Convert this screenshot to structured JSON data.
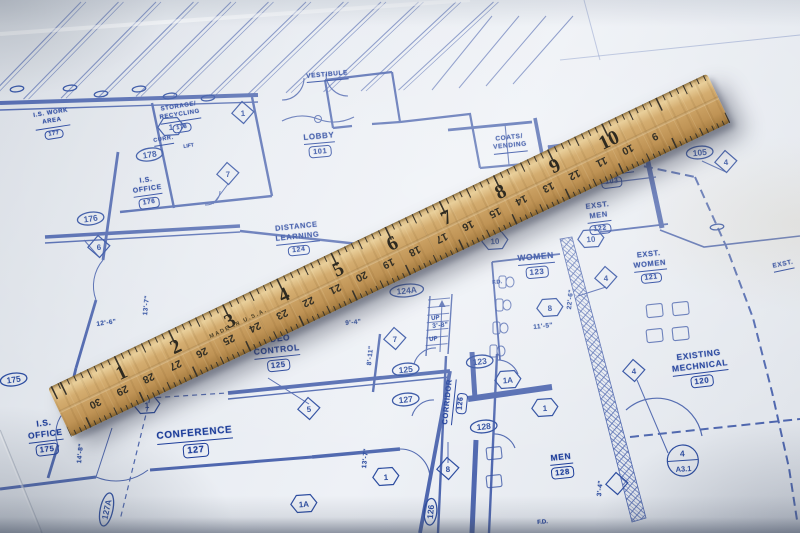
{
  "colors": {
    "ink": "#3a55a5",
    "ink_bold": "#1d3d9a",
    "paper": "#e7ebf1",
    "wood": "#c99f61",
    "tick": "#39342b"
  },
  "blueprint": {
    "rooms": [
      {
        "id": "is-work-area",
        "lines": [
          "I.S. WORK",
          "AREA"
        ],
        "number": "177"
      },
      {
        "id": "storage-recycling",
        "lines": [
          "STORAGE/",
          "RECYCLING"
        ],
        "number": "178"
      },
      {
        "id": "curr",
        "lines": [
          "CURR."
        ],
        "number": ""
      },
      {
        "id": "is-office-176",
        "lines": [
          "I.S.",
          "OFFICE"
        ],
        "number": "176"
      },
      {
        "id": "vestibule",
        "lines": [
          "VESTIBULE"
        ],
        "number": ""
      },
      {
        "id": "lobby",
        "lines": [
          "LOBBY"
        ],
        "number": "101"
      },
      {
        "id": "coats-vending",
        "lines": [
          "COATS/",
          "VENDING"
        ],
        "number": ""
      },
      {
        "id": "corridor-103",
        "lines": [
          "CORRIDOR"
        ],
        "number": "103"
      },
      {
        "id": "exst-men",
        "lines": [
          "EXST.",
          "MEN"
        ],
        "number": "122"
      },
      {
        "id": "women",
        "lines": [
          "WOMEN"
        ],
        "number": "123"
      },
      {
        "id": "exst-women",
        "lines": [
          "EXST.",
          "WOMEN"
        ],
        "number": "121"
      },
      {
        "id": "existing-mechanical",
        "lines": [
          "EXISTING",
          "MECHNICAL"
        ],
        "number": "120"
      },
      {
        "id": "distance-learning",
        "lines": [
          "DISTANCE",
          "LEARNING"
        ],
        "number": "124"
      },
      {
        "id": "video-control",
        "lines": [
          "VIDEO",
          "CONTROL"
        ],
        "number": "125"
      },
      {
        "id": "conference",
        "lines": [
          "CONFERENCE"
        ],
        "number": "127"
      },
      {
        "id": "corridor-126",
        "lines": [
          "CORRIDOR"
        ],
        "number": "126"
      },
      {
        "id": "men-128",
        "lines": [
          "MEN"
        ],
        "number": "128"
      },
      {
        "id": "is-office-175",
        "lines": [
          "I.S.",
          "OFFICE"
        ],
        "number": "175"
      },
      {
        "id": "exst-edge",
        "lines": [
          "EXST."
        ],
        "number": ""
      }
    ],
    "tags": [
      {
        "id": "tag-124a",
        "shape": "oval",
        "value": "124A"
      },
      {
        "id": "tag-125",
        "shape": "oval",
        "value": "125"
      },
      {
        "id": "tag-127",
        "shape": "oval",
        "value": "127"
      },
      {
        "id": "tag-123",
        "shape": "oval",
        "value": "123"
      },
      {
        "id": "tag-128",
        "shape": "oval",
        "value": "128"
      },
      {
        "id": "tag-126",
        "shape": "oval",
        "value": "126"
      },
      {
        "id": "tag-127a",
        "shape": "oval",
        "value": "127A"
      },
      {
        "id": "tag-175",
        "shape": "oval",
        "value": "175"
      },
      {
        "id": "tag-176",
        "shape": "oval",
        "value": "176"
      },
      {
        "id": "tag-178",
        "shape": "oval",
        "value": "178"
      },
      {
        "id": "tag-105",
        "shape": "oval",
        "value": "105"
      },
      {
        "id": "d-7",
        "shape": "diamond",
        "value": "7"
      },
      {
        "id": "d-5",
        "shape": "diamond",
        "value": "5"
      },
      {
        "id": "d-4",
        "shape": "diamond",
        "value": "4"
      },
      {
        "id": "d-8",
        "shape": "diamond",
        "value": "8"
      },
      {
        "id": "d-6",
        "shape": "diamond",
        "value": "6"
      },
      {
        "id": "d-4b",
        "shape": "diamond",
        "value": "4"
      },
      {
        "id": "d-4c",
        "shape": "diamond",
        "value": "4"
      },
      {
        "id": "d-7b",
        "shape": "diamond",
        "value": "7"
      },
      {
        "id": "d-1e",
        "shape": "diamond",
        "value": "1"
      },
      {
        "id": "d-blank",
        "shape": "diamond",
        "value": ""
      },
      {
        "id": "h-1",
        "shape": "hexagon",
        "value": "1"
      },
      {
        "id": "h-1b",
        "shape": "hexagon",
        "value": "1"
      },
      {
        "id": "h-1a",
        "shape": "hexagon",
        "value": "1A"
      },
      {
        "id": "h-1a2",
        "shape": "hexagon",
        "value": "1A"
      },
      {
        "id": "h-1c",
        "shape": "hexagon",
        "value": "1"
      },
      {
        "id": "h-8",
        "shape": "hexagon",
        "value": "8"
      },
      {
        "id": "h-10",
        "shape": "hexagon",
        "value": "10"
      },
      {
        "id": "h-10b",
        "shape": "hexagon",
        "value": "10"
      },
      {
        "id": "h-1d",
        "shape": "hexagon",
        "value": "1"
      },
      {
        "id": "detail-a31",
        "shape": "circle-detail",
        "value": "4",
        "value2": "A3.1"
      },
      {
        "id": "so1",
        "shape": "oval",
        "value": ""
      },
      {
        "id": "so2",
        "shape": "oval",
        "value": ""
      },
      {
        "id": "so3",
        "shape": "oval",
        "value": ""
      },
      {
        "id": "so4",
        "shape": "oval",
        "value": ""
      },
      {
        "id": "so5",
        "shape": "oval",
        "value": ""
      },
      {
        "id": "so6",
        "shape": "oval",
        "value": ""
      },
      {
        "id": "so7",
        "shape": "oval",
        "value": ""
      }
    ],
    "dimensions": [
      {
        "id": "dim-12-6",
        "value": "12'-6\""
      },
      {
        "id": "dim-14-8",
        "value": "14'-8\""
      },
      {
        "id": "dim-13-7a",
        "value": "13'-7\""
      },
      {
        "id": "dim-9-4",
        "value": "9'-4\""
      },
      {
        "id": "dim-5",
        "value": "5\""
      },
      {
        "id": "dim-8-11",
        "value": "8'-11\""
      },
      {
        "id": "dim-13-7b",
        "value": "13'-7\""
      },
      {
        "id": "dim-22-6",
        "value": "22'-6\""
      },
      {
        "id": "dim-11-5",
        "value": "11'-5\""
      },
      {
        "id": "dim-3-8",
        "value": "3'-8\""
      },
      {
        "id": "dim-3-4",
        "value": "3'-4\""
      }
    ],
    "annotations": [
      {
        "id": "ann-up1",
        "value": "UP"
      },
      {
        "id": "ann-up2",
        "value": "UP"
      },
      {
        "id": "ann-fd1",
        "value": "F.D."
      },
      {
        "id": "ann-fd2",
        "value": "F.D."
      },
      {
        "id": "ann-lift",
        "value": "LIFT"
      }
    ]
  },
  "ruler": {
    "brand_text": "MADE IN U.S.A.",
    "inch_numbers": [
      "1",
      "2",
      "3",
      "4",
      "5",
      "6",
      "7",
      "8",
      "9",
      "10"
    ],
    "cm_numbers": [
      "30",
      "29",
      "28",
      "27",
      "26",
      "25",
      "24",
      "23",
      "22",
      "21",
      "20",
      "19",
      "18",
      "17",
      "16",
      "15",
      "14",
      "13",
      "12",
      "11",
      "10",
      "9"
    ]
  }
}
